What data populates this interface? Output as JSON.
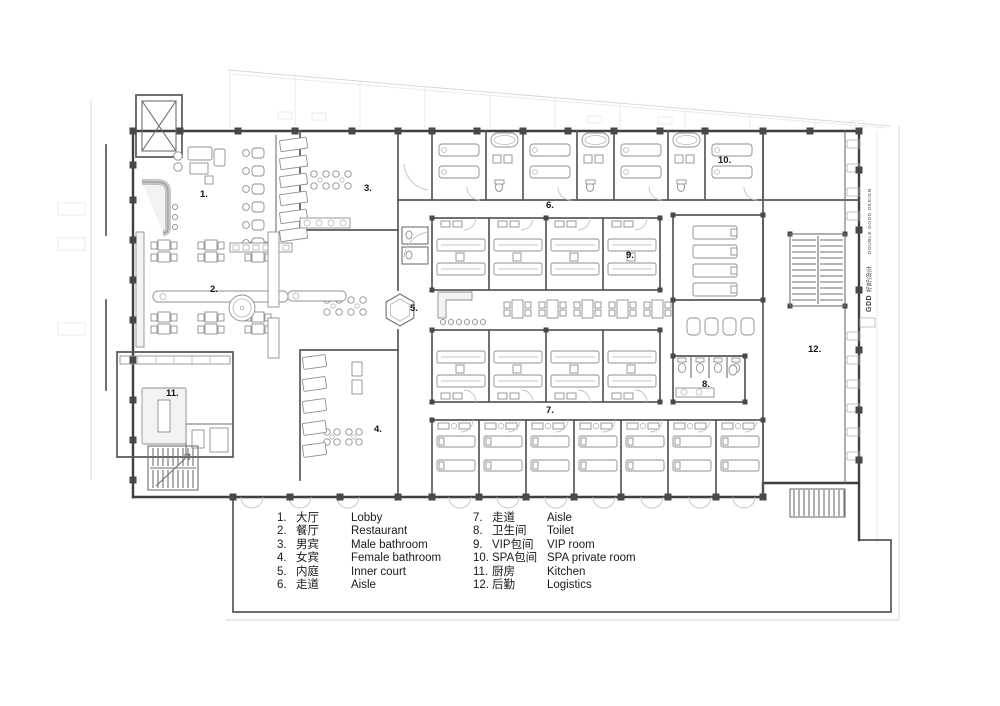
{
  "plan": {
    "room_labels": [
      {
        "num": "1.",
        "x": 200,
        "y": 197
      },
      {
        "num": "2.",
        "x": 210,
        "y": 292
      },
      {
        "num": "3.",
        "x": 364,
        "y": 191
      },
      {
        "num": "4.",
        "x": 374,
        "y": 432
      },
      {
        "num": "5.",
        "x": 410,
        "y": 311
      },
      {
        "num": "6.",
        "x": 546,
        "y": 208
      },
      {
        "num": "7.",
        "x": 546,
        "y": 413
      },
      {
        "num": "8.",
        "x": 702,
        "y": 387
      },
      {
        "num": "9.",
        "x": 626,
        "y": 258
      },
      {
        "num": "10.",
        "x": 718,
        "y": 163
      },
      {
        "num": "11.",
        "x": 166,
        "y": 396
      },
      {
        "num": "12.",
        "x": 808,
        "y": 352
      }
    ],
    "watermark": {
      "logo": "GDD",
      "cn": "好|好|设|计",
      "en": "DOUBLE GOOD DESIGN"
    }
  },
  "legend": {
    "columns": [
      {
        "items": [
          {
            "num": "1.",
            "cn": "大厅",
            "en": "Lobby"
          },
          {
            "num": "2.",
            "cn": "餐厅",
            "en": "Restaurant"
          },
          {
            "num": "3.",
            "cn": "男宾",
            "en": "Male bathroom"
          },
          {
            "num": "4.",
            "cn": "女宾",
            "en": "Female bathroom"
          },
          {
            "num": "5.",
            "cn": "内庭",
            "en": "Inner court"
          },
          {
            "num": "6.",
            "cn": "走道",
            "en": "Aisle"
          }
        ]
      },
      {
        "items": [
          {
            "num": "7.",
            "cn": "走道",
            "en": "Aisle"
          },
          {
            "num": "8.",
            "cn": "卫生间",
            "en": "Toilet"
          },
          {
            "num": "9.",
            "cn": "VIP包间",
            "en": "VIP room"
          },
          {
            "num": "10.",
            "cn": "SPA包间",
            "en": "SPA private room"
          },
          {
            "num": "11.",
            "cn": "厨房",
            "en": "Kitchen"
          },
          {
            "num": "12.",
            "cn": "后勤",
            "en": "Logistics"
          }
        ]
      }
    ]
  },
  "colors": {
    "wall": "#3f3f3f",
    "partition": "#585858",
    "furniture": "#8f8f8f",
    "site_line": "#d9d9d9",
    "door_arc": "#c2c2c2",
    "text": "#1a1a1a"
  }
}
